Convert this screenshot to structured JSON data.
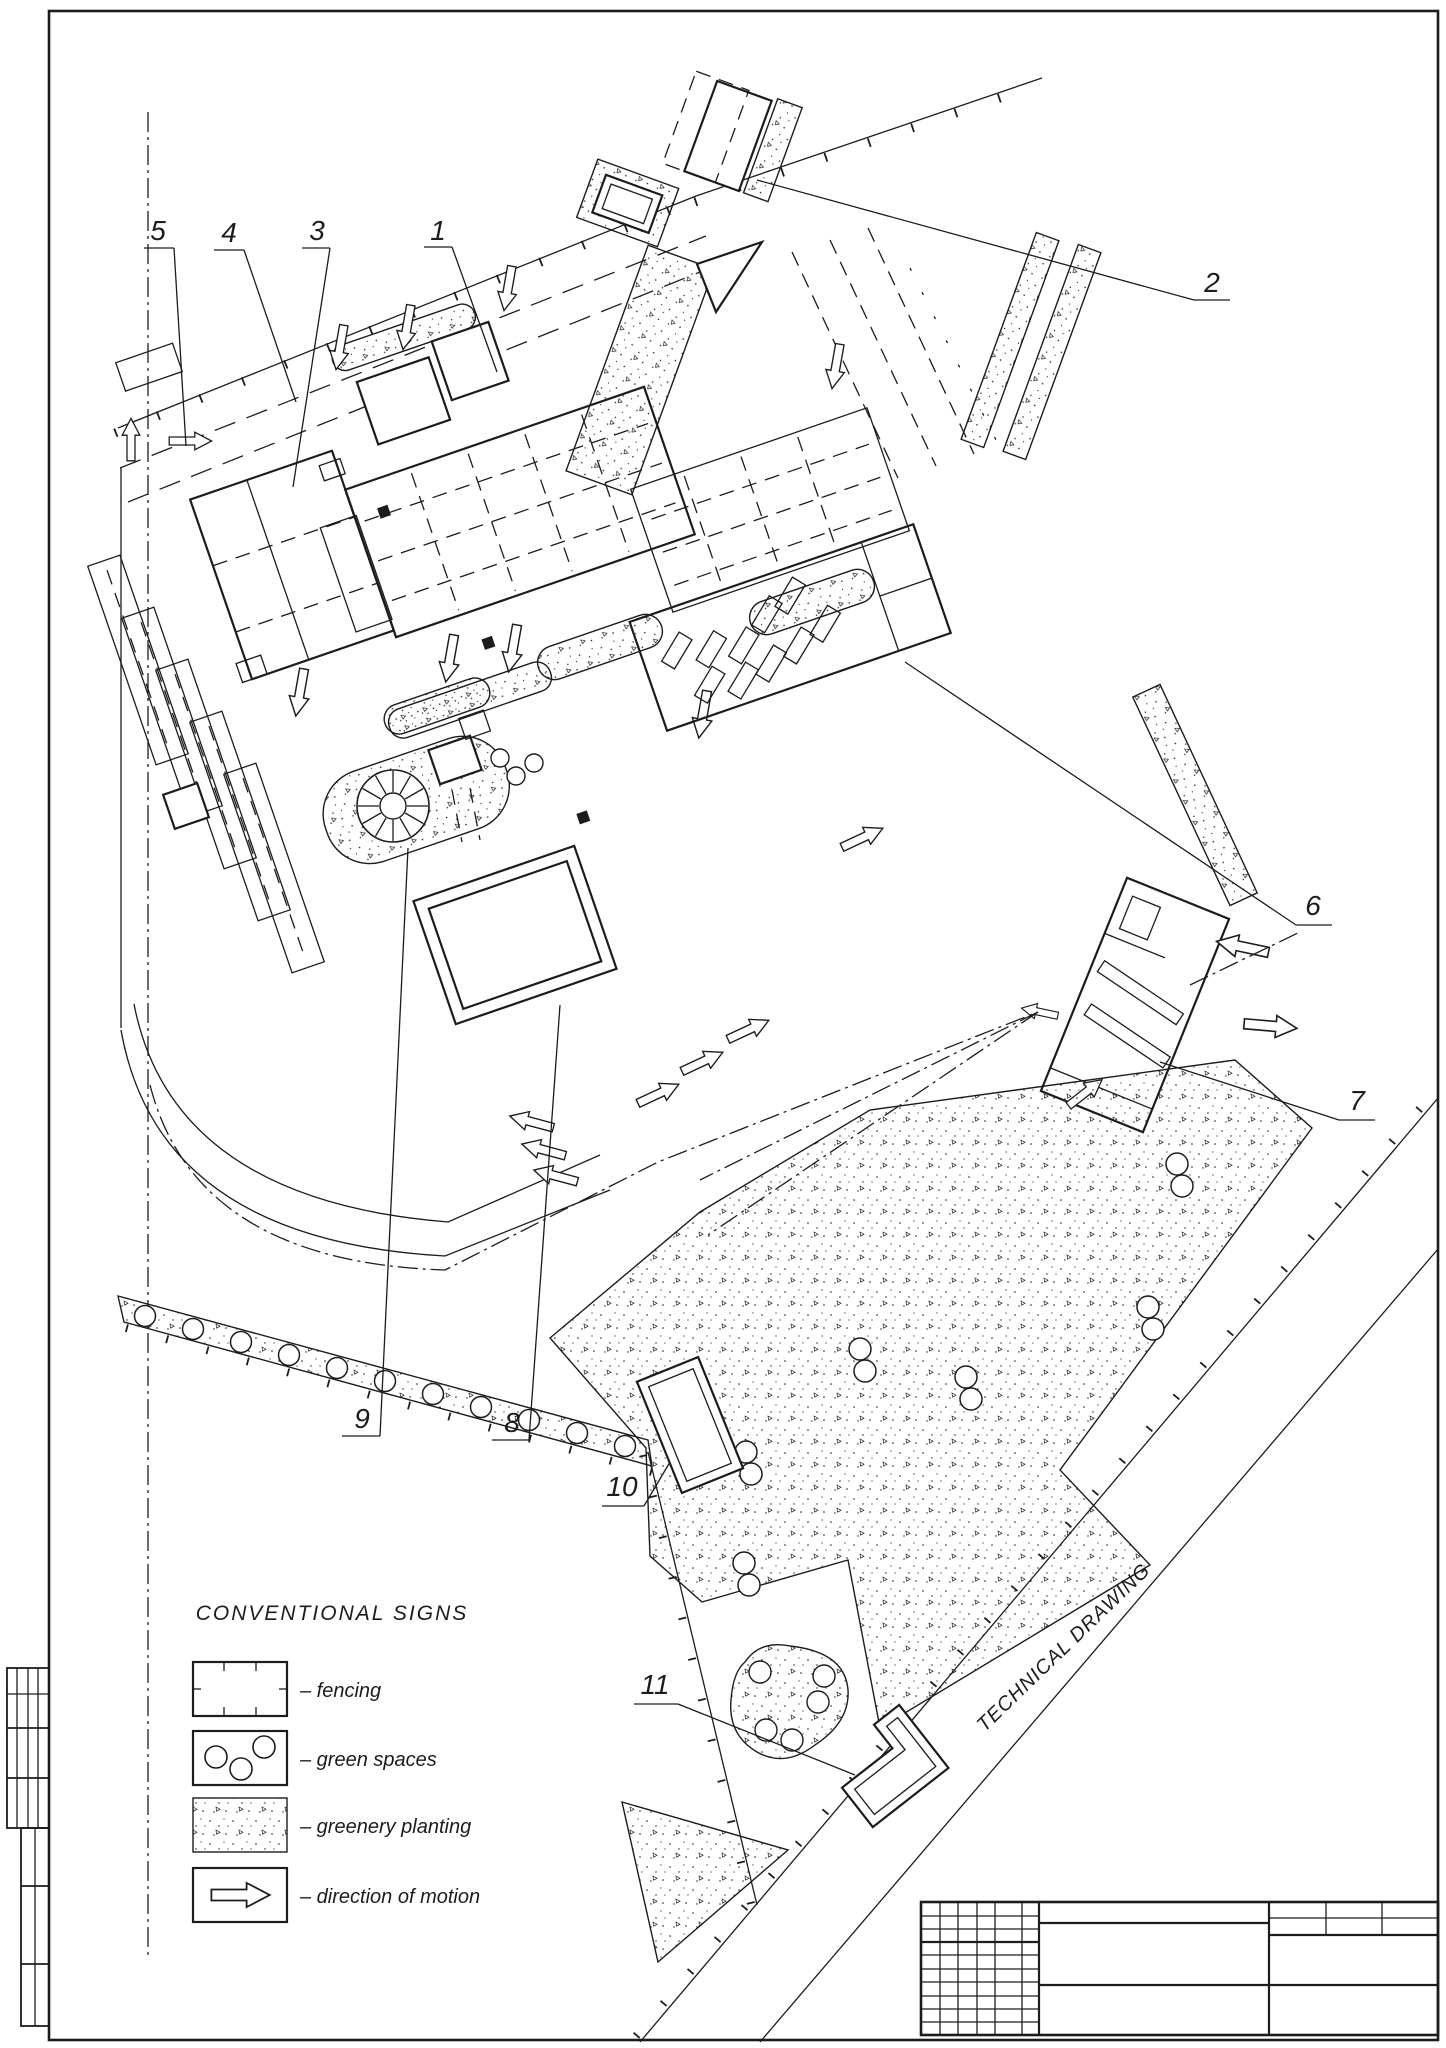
{
  "plan": {
    "type": "site master plan, monochrome CAD technical drawing",
    "road_label": "TECHNICAL DRAWING",
    "callouts": [
      {
        "n": "1"
      },
      {
        "n": "2"
      },
      {
        "n": "3"
      },
      {
        "n": "4"
      },
      {
        "n": "5"
      },
      {
        "n": "6"
      },
      {
        "n": "7"
      },
      {
        "n": "8"
      },
      {
        "n": "9"
      },
      {
        "n": "10"
      },
      {
        "n": "11"
      }
    ]
  },
  "legend": {
    "title": "CONVENTIONAL SIGNS",
    "items": [
      {
        "label": "– fencing"
      },
      {
        "label": "– green spaces"
      },
      {
        "label": "– greenery planting"
      },
      {
        "label": "– direction of motion"
      }
    ]
  },
  "colors": {
    "ink": "#1c1c1c",
    "paper": "#ffffff"
  }
}
